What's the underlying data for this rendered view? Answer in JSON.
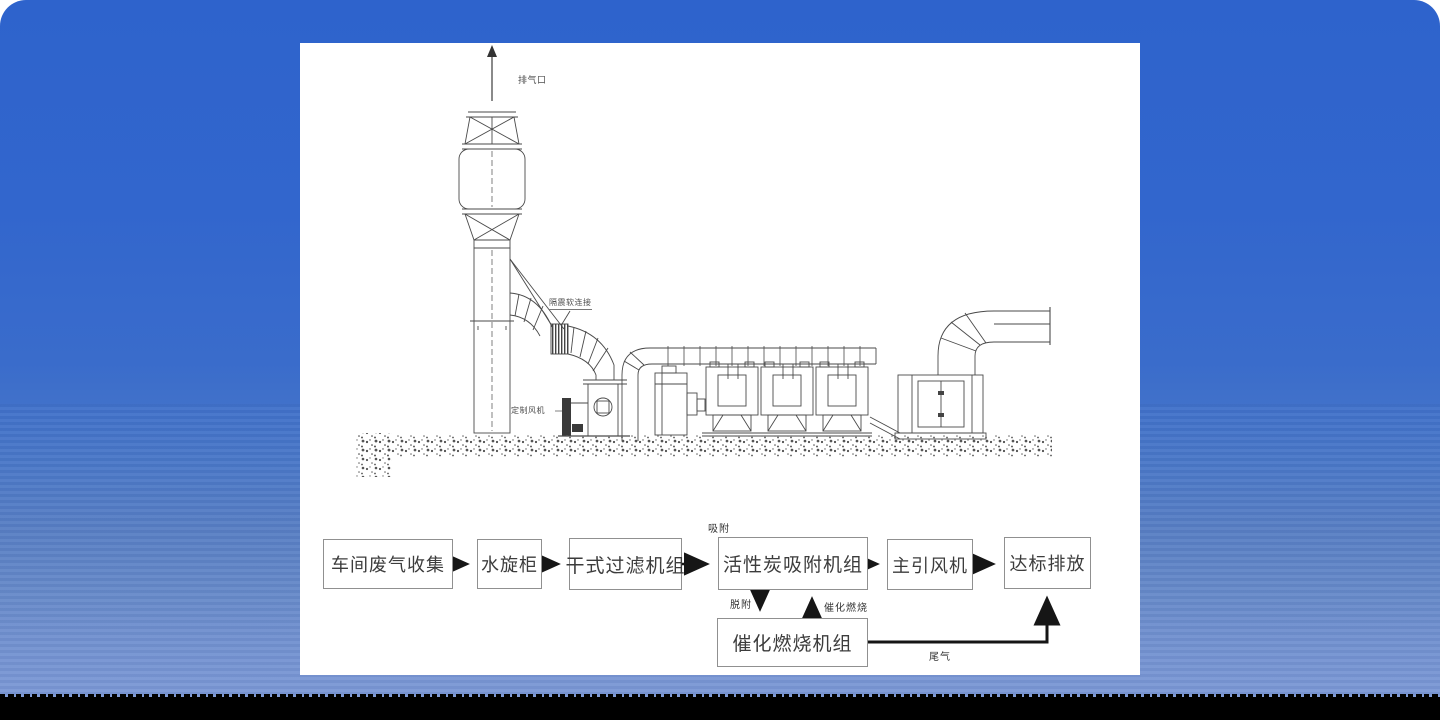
{
  "colors": {
    "background_blue_top": "#2e63cc",
    "background_blue_bottom": "#7d99d6",
    "bottom_bar": "#000000",
    "panel_background": "#ffffff",
    "line_art": "#4a4a4a",
    "flow_arrow": "#161616"
  },
  "drawing": {
    "labels": {
      "exhaust_outlet": "排气口",
      "vibration_flex_connection": "隔震软连接",
      "custom_fan": "定制风机"
    }
  },
  "flowchart": {
    "boxes": [
      {
        "id": "workshop-gas-collection",
        "label": "车间废气收集"
      },
      {
        "id": "water-spray-cabinet",
        "label": "水旋柜"
      },
      {
        "id": "dry-filter-unit",
        "label": "干式过滤机组"
      },
      {
        "id": "activated-carbon-adsorption-unit",
        "label": "活性炭吸附机组"
      },
      {
        "id": "main-draft-fan",
        "label": "主引风机"
      },
      {
        "id": "compliant-discharge",
        "label": "达标排放"
      },
      {
        "id": "catalytic-combustion-unit",
        "label": "催化燃烧机组"
      }
    ],
    "edge_labels": {
      "adsorption": "吸附",
      "desorption": "脱附",
      "catalytic_combustion": "催化燃烧",
      "tail_gas": "尾气"
    }
  }
}
